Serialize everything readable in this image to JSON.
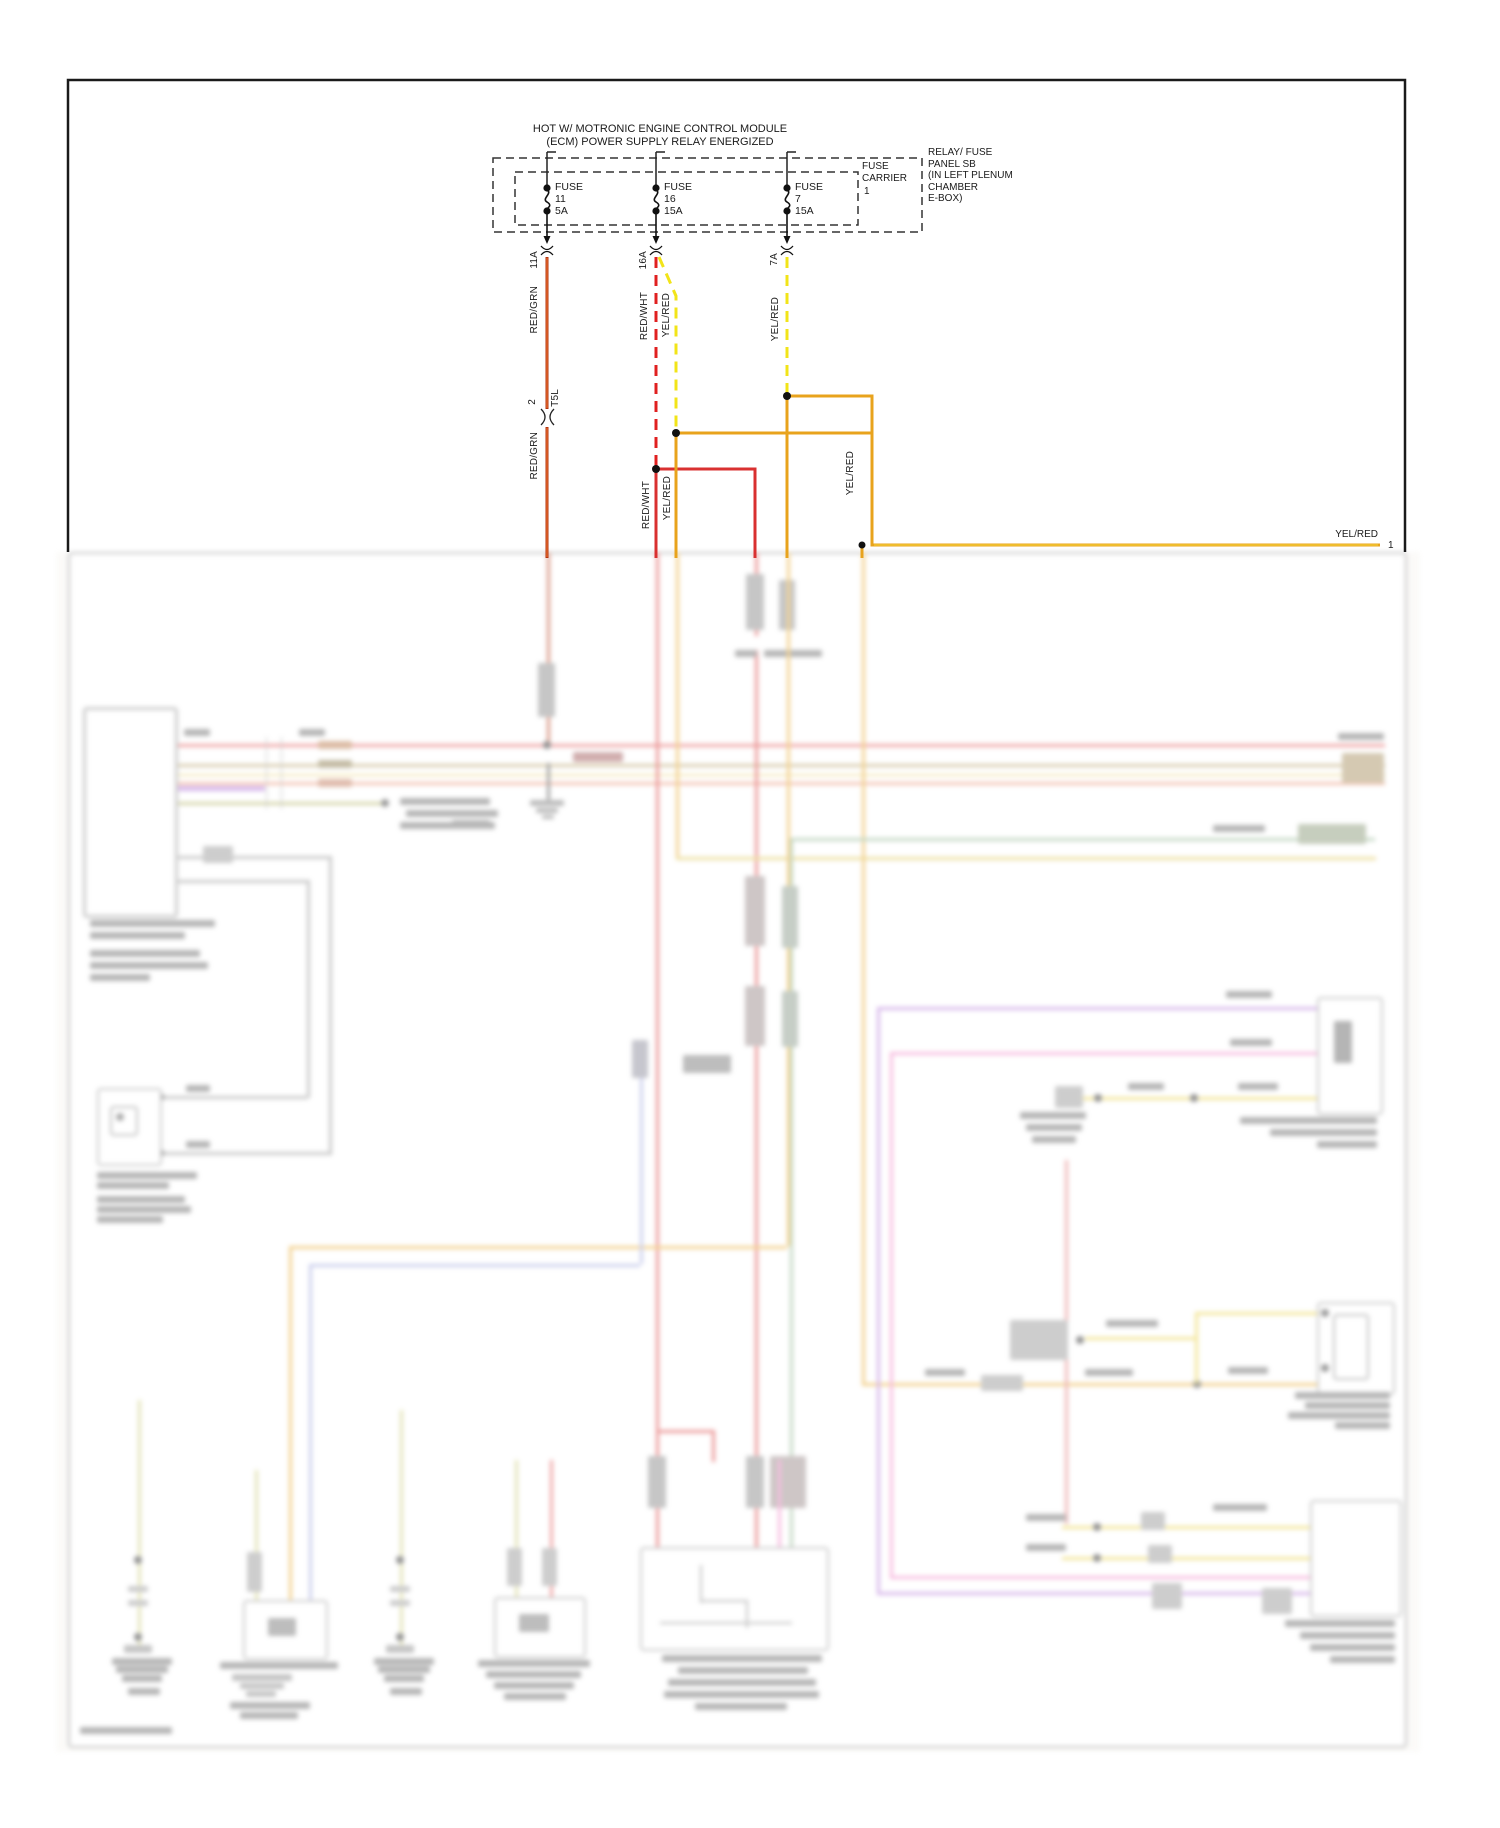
{
  "diagram": {
    "header": {
      "line1": "HOT W/ MOTRONIC ENGINE CONTROL MODULE",
      "line2": "(ECM) POWER SUPPLY RELAY ENERGIZED"
    },
    "fuse_panel": {
      "carrier_label": "FUSE CARRIER",
      "carrier_number": "1",
      "location_lines": [
        "RELAY/ FUSE",
        "PANEL SB",
        "(IN LEFT PLENUM",
        "CHAMBER",
        "E-BOX)"
      ]
    },
    "fuses": [
      {
        "label": "FUSE",
        "number": "11",
        "rating": "5A",
        "pin": "11A"
      },
      {
        "label": "FUSE",
        "number": "16",
        "rating": "15A",
        "pin": "16A"
      },
      {
        "label": "FUSE",
        "number": "7",
        "rating": "15A",
        "pin": "7A"
      }
    ],
    "wires": {
      "red_grn": "RED/GRN",
      "red_wht": "RED/WHT",
      "yel_red": "YEL/RED"
    },
    "inline_connector": {
      "pin": "2",
      "code": "T5L"
    },
    "right_exit": {
      "label": "YEL/RED",
      "pin": "1"
    },
    "colors": {
      "red_grn": "#b5330f",
      "red_wht_dashed": "#e02020",
      "yel_red_dashed": "#f2e418",
      "yel_red_solid": "#e8a31d",
      "red_solid": "#d93030"
    }
  }
}
